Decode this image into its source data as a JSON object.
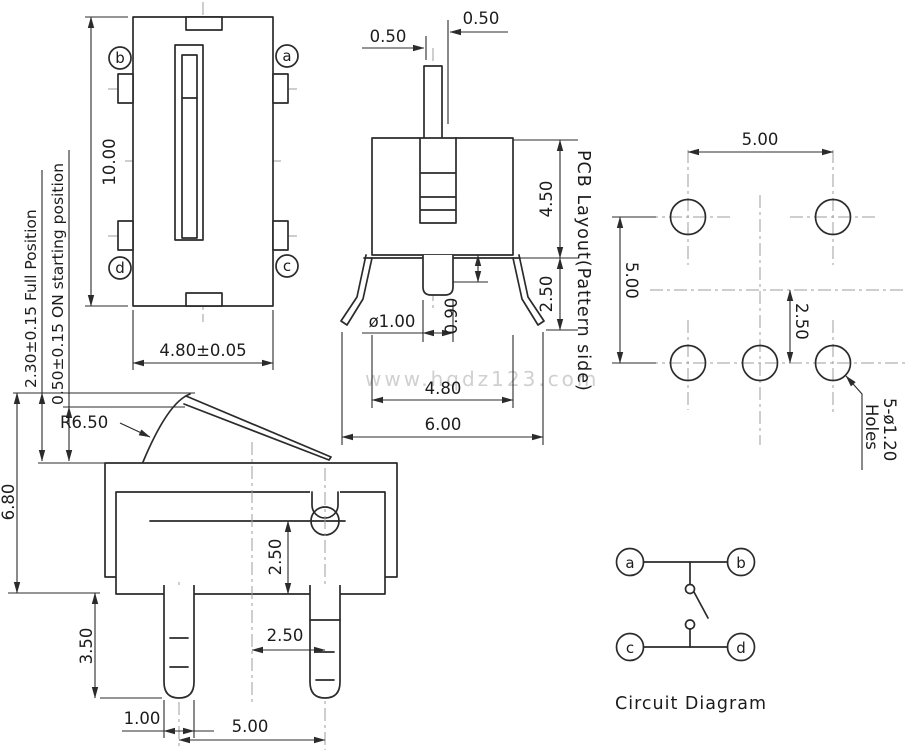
{
  "watermark": "www.hqdz123.com",
  "top_view": {
    "terminals": {
      "tl": "b",
      "tr": "a",
      "bl": "d",
      "br": "c"
    },
    "dims": {
      "height": "10.00",
      "width": "4.80±0.05"
    }
  },
  "front_view": {
    "dims": {
      "stem_left": "0.50",
      "stem_right": "0.50",
      "body_height": "4.50",
      "bracket_drop": "2.50",
      "pin_width": "ø1.00",
      "pin_length": "0.90",
      "body_width": "4.80",
      "bracket_span": "6.00"
    }
  },
  "side_view": {
    "notes": {
      "full_position": "2.30±0.15 Full Position",
      "on_starting": "0.50±0.15 ON starting position"
    },
    "dims": {
      "lever_radius": "R6.50",
      "overall_height": "6.80",
      "pivot_depth": "2.50",
      "leg_length": "3.50",
      "leg_offset": "2.50",
      "leg_width": "1.00",
      "leg_pitch": "5.00"
    }
  },
  "pcb_layout": {
    "title": "PCB Layout(Pattern side)",
    "dims": {
      "pitch_x": "5.00",
      "pitch_y": "5.00",
      "offset": "2.50"
    },
    "holes_note": {
      "line1": "5-ø1.20",
      "line2": "Holes"
    }
  },
  "circuit_diagram": {
    "caption": "Circuit Diagram",
    "terminals": {
      "tl": "a",
      "tr": "b",
      "bl": "c",
      "br": "d"
    }
  }
}
